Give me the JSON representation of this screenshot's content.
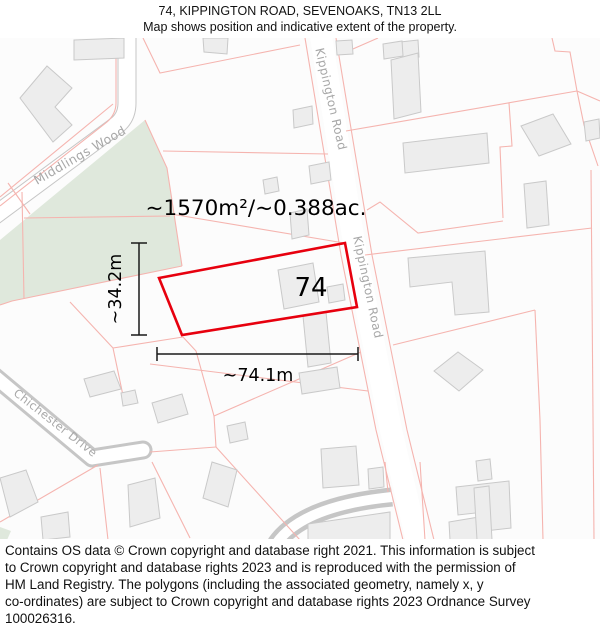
{
  "header": {
    "title": "74, KIPPINGTON ROAD, SEVENOAKS, TN13 2LL",
    "subtitle": "Map shows position and indicative extent of the property."
  },
  "map": {
    "plot": {
      "number": "74",
      "area_label": "~1570m²/~0.388ac.",
      "width_label": "~74.1m",
      "height_label": "~34.2m"
    },
    "roads": {
      "kippington_top": "Kippington Road",
      "kippington_bottom": "Kippington Road",
      "middlings_wood": "Middlings Wood",
      "chichester_drive": "Chichester Drive"
    }
  },
  "colors": {
    "plot_outline_red": "#e7000e",
    "parcel_boundary_pink": "#f5b4af",
    "building_fill": "#ededed",
    "building_stroke": "#c9c9c9",
    "woodland_green": "#dfe8dc",
    "road_casing_gray": "#c6c6c6",
    "road_label_gray": "#a8a8a8",
    "dimension_black": "#1a1a1a"
  },
  "footer": {
    "lines": [
      "Contains OS data © Crown copyright and database right 2021. This information is subject",
      "to Crown copyright and database rights 2023 and is reproduced with the permission of",
      "HM Land Registry. The polygons (including the associated geometry, namely x, y",
      "co-ordinates) are subject to Crown copyright and database rights 2023 Ordnance Survey",
      "100026316."
    ]
  }
}
